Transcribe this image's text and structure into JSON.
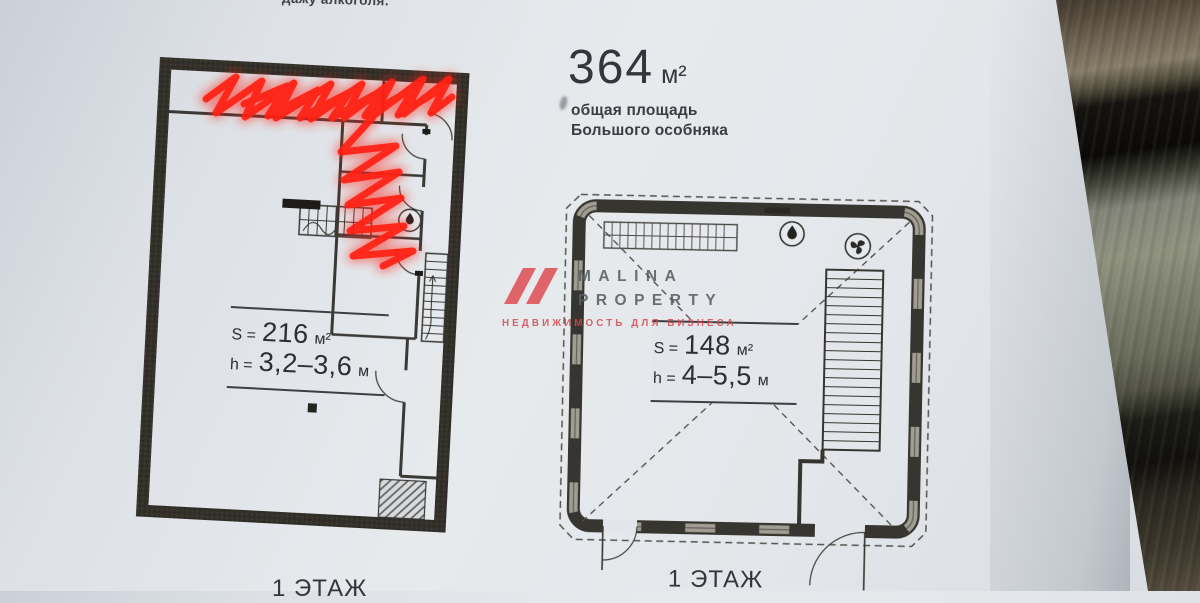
{
  "document": {
    "top_note": "дажу алкоголя.",
    "summary": {
      "value": "364",
      "unit": "м²",
      "caption_line1": "общая площадь",
      "caption_line2": "Большого особняка"
    },
    "left_plan": {
      "area_prefix": "S =",
      "area_value": "216",
      "area_unit": "м²",
      "height_prefix": "h =",
      "height_value": "3,2–3,6",
      "height_unit": "м",
      "floor_label": "1 ЭТАЖ"
    },
    "right_plan": {
      "area_prefix": "S =",
      "area_value": "148",
      "area_unit": "м²",
      "height_prefix": "h =",
      "height_value": "4–5,5",
      "height_unit": "м",
      "floor_label": "1 ЭТАЖ"
    },
    "watermark": {
      "brand_top": "MALINA",
      "brand_bottom": "PROPERTY",
      "tagline": "НЕДВИЖИМОСТЬ ДЛЯ БИЗНЕСА"
    },
    "colors": {
      "annotation_red": "#ff2012",
      "paper": "#e3e6ea",
      "wall_dark": "#34322e",
      "watermark_red": "#dd3f45",
      "watermark_gray": "#6d7075"
    }
  }
}
